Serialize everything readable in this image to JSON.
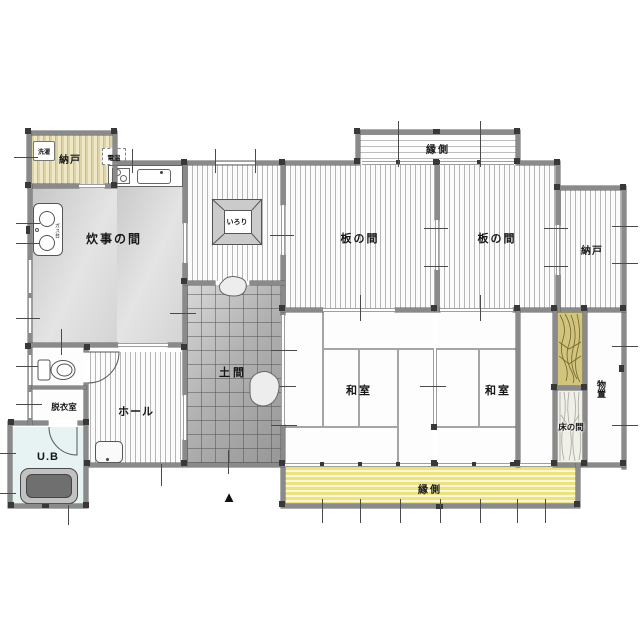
{
  "rooms": {
    "nando_top_left": {
      "label": "納戸"
    },
    "laundry": {
      "label": "洗濯"
    },
    "water_heater": {
      "label": "電温"
    },
    "kitchen": {
      "label": "炊事の間"
    },
    "stove": {
      "label": "ガス台"
    },
    "irori": {
      "label": "いろり"
    },
    "itanoma_left": {
      "label": "板の間"
    },
    "itanoma_right": {
      "label": "板の間"
    },
    "nando_right": {
      "label": "納戸"
    },
    "engawa_top": {
      "label": "縁側"
    },
    "washitsu_left": {
      "label": "和室"
    },
    "washitsu_right": {
      "label": "和室"
    },
    "doma": {
      "label": "土間"
    },
    "hall": {
      "label": "ホール"
    },
    "dressing_room": {
      "label": "脱衣室"
    },
    "unit_bath": {
      "label": "U.B"
    },
    "tokonoma": {
      "label": "床の間"
    },
    "storage_shed": {
      "label": "物置"
    },
    "engawa_bottom": {
      "label": "縁側"
    }
  },
  "markers": {
    "entrance_triangle": "▲"
  },
  "colors": {
    "wall": "#8a8a8a",
    "post": "#383838",
    "floor_stripe": "#b6b6b6",
    "beige_floor": "#ded3a2",
    "engawa_yellow": "#ece283",
    "doma_gray": "#b2b2b2",
    "wood_grain": "#d2c47c",
    "unit_bath_blue": "#e7f2f3",
    "bathtub_gray": "#6f6f6f",
    "outline": "#555555"
  }
}
